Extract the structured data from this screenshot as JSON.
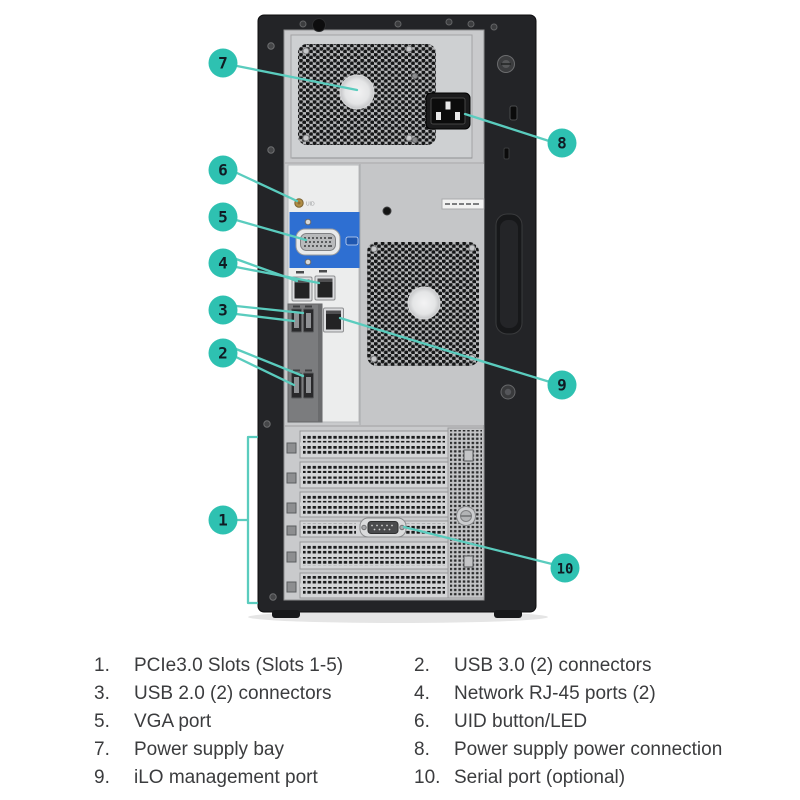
{
  "figure": {
    "kind": "server rear panel callout diagram",
    "device": "tower server rear view"
  },
  "colors": {
    "callout_fill": "#2ec1b1",
    "callout_line": "#5accbe",
    "vga_blue": "#2e6fd2"
  },
  "callouts": [
    {
      "num": "1"
    },
    {
      "num": "2"
    },
    {
      "num": "3"
    },
    {
      "num": "4"
    },
    {
      "num": "5"
    },
    {
      "num": "6"
    },
    {
      "num": "7"
    },
    {
      "num": "8"
    },
    {
      "num": "9"
    },
    {
      "num": "10"
    }
  ],
  "panel": {
    "uid_label": "UID"
  },
  "legend": {
    "left": [
      {
        "num": "1.",
        "label": "PCIe3.0 Slots (Slots 1-5)"
      },
      {
        "num": "3.",
        "label": "USB 2.0 (2) connectors"
      },
      {
        "num": "5.",
        "label": "VGA port"
      },
      {
        "num": "7.",
        "label": "Power supply bay"
      },
      {
        "num": "9.",
        "label": "iLO management port"
      }
    ],
    "right": [
      {
        "num": "2.",
        "label": "USB 3.0 (2) connectors"
      },
      {
        "num": "4.",
        "label": "Network RJ-45 ports (2)"
      },
      {
        "num": "6.",
        "label": "UID button/LED"
      },
      {
        "num": "8.",
        "label": "Power supply power connection"
      },
      {
        "num": "10.",
        "label": "Serial port (optional)"
      }
    ]
  }
}
